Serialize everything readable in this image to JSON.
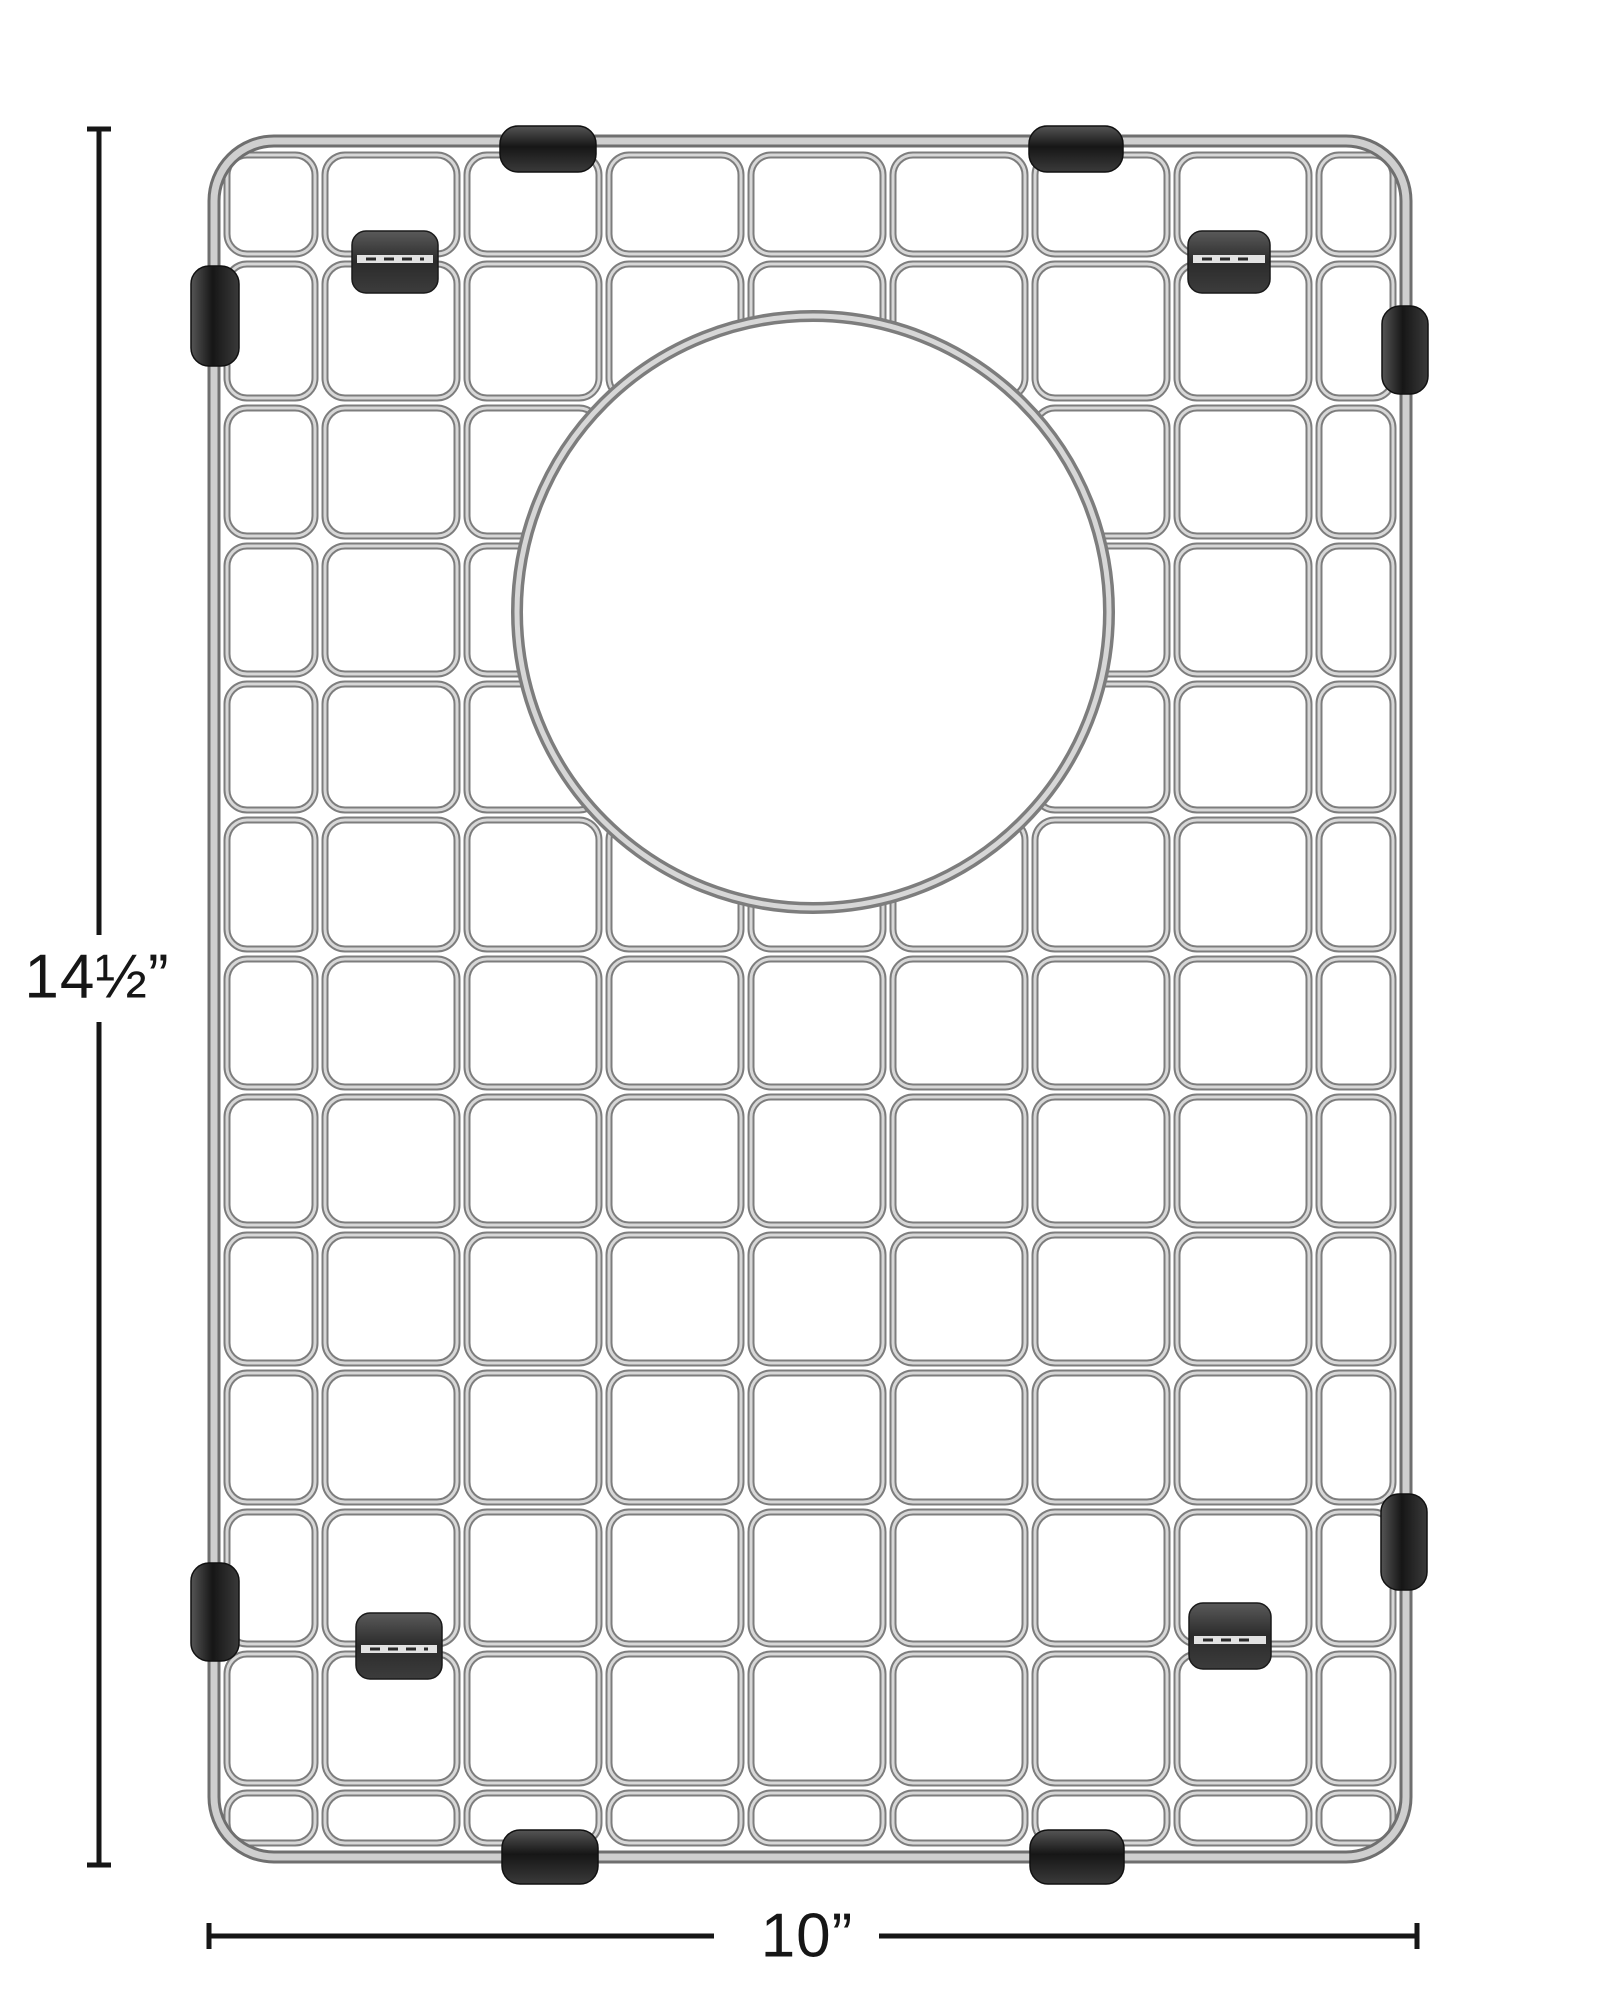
{
  "dimension_labels": {
    "height": "14½”",
    "width": "10”"
  },
  "colors": {
    "background": "#ffffff",
    "wire_edge": "#7d7d7d",
    "wire_face": "#d7d7d7",
    "frame_edge": "#6f6f6f",
    "frame_face": "#cfcfcf",
    "ring_edge": "#7d7d7d",
    "ring_face": "#d7d7d7",
    "rubber_dark": "#161616",
    "rubber_mid": "#3a3a3a",
    "rubber_light": "#555555",
    "dimension_line": "#161616"
  },
  "diagram": {
    "frame": {
      "x": 214,
      "y": 141,
      "w": 1192,
      "h": 1716,
      "r": 60
    },
    "cols": [
      222,
      320,
      462,
      604,
      746,
      888,
      1030,
      1172,
      1314,
      1398
    ],
    "rows": [
      150,
      259,
      403,
      541,
      679,
      815,
      954,
      1092,
      1230,
      1368,
      1507,
      1649,
      1788,
      1848
    ],
    "cell_inset": 5,
    "cell_radius": 20,
    "circle": {
      "cx": 813,
      "cy": 612,
      "r": 296
    },
    "feet": [
      {
        "x": 500,
        "y": 126,
        "w": 96,
        "h": 46,
        "orient": "h"
      },
      {
        "x": 1029,
        "y": 126,
        "w": 94,
        "h": 46,
        "orient": "h"
      },
      {
        "x": 191,
        "y": 266,
        "w": 48,
        "h": 100,
        "orient": "v"
      },
      {
        "x": 191,
        "y": 1563,
        "w": 48,
        "h": 98,
        "orient": "v"
      },
      {
        "x": 1382,
        "y": 306,
        "w": 46,
        "h": 88,
        "orient": "v"
      },
      {
        "x": 1381,
        "y": 1494,
        "w": 46,
        "h": 96,
        "orient": "v"
      },
      {
        "x": 502,
        "y": 1830,
        "w": 96,
        "h": 54,
        "orient": "h"
      },
      {
        "x": 1030,
        "y": 1830,
        "w": 94,
        "h": 54,
        "orient": "h"
      }
    ],
    "clips": [
      {
        "x": 352,
        "y": 231,
        "w": 86,
        "h": 62,
        "slot_y": 259
      },
      {
        "x": 1188,
        "y": 231,
        "w": 82,
        "h": 62,
        "slot_y": 259
      },
      {
        "x": 356,
        "y": 1613,
        "w": 86,
        "h": 66,
        "slot_y": 1649
      },
      {
        "x": 1189,
        "y": 1603,
        "w": 82,
        "h": 66,
        "slot_y": 1640
      }
    ],
    "dimension_lines": {
      "stroke_width": 5,
      "vertical": {
        "x": 99,
        "y1": 127,
        "y2": 1867,
        "gap_top": 935,
        "gap_bottom": 1022,
        "tick_half": 12
      },
      "horizontal": {
        "y": 1936,
        "x1": 207,
        "x2": 1419,
        "gap_left": 714,
        "gap_right": 879,
        "tick_half": 13
      }
    },
    "labels": {
      "height": {
        "x": 97,
        "y": 977
      },
      "width": {
        "x": 807,
        "y": 1936
      }
    }
  }
}
